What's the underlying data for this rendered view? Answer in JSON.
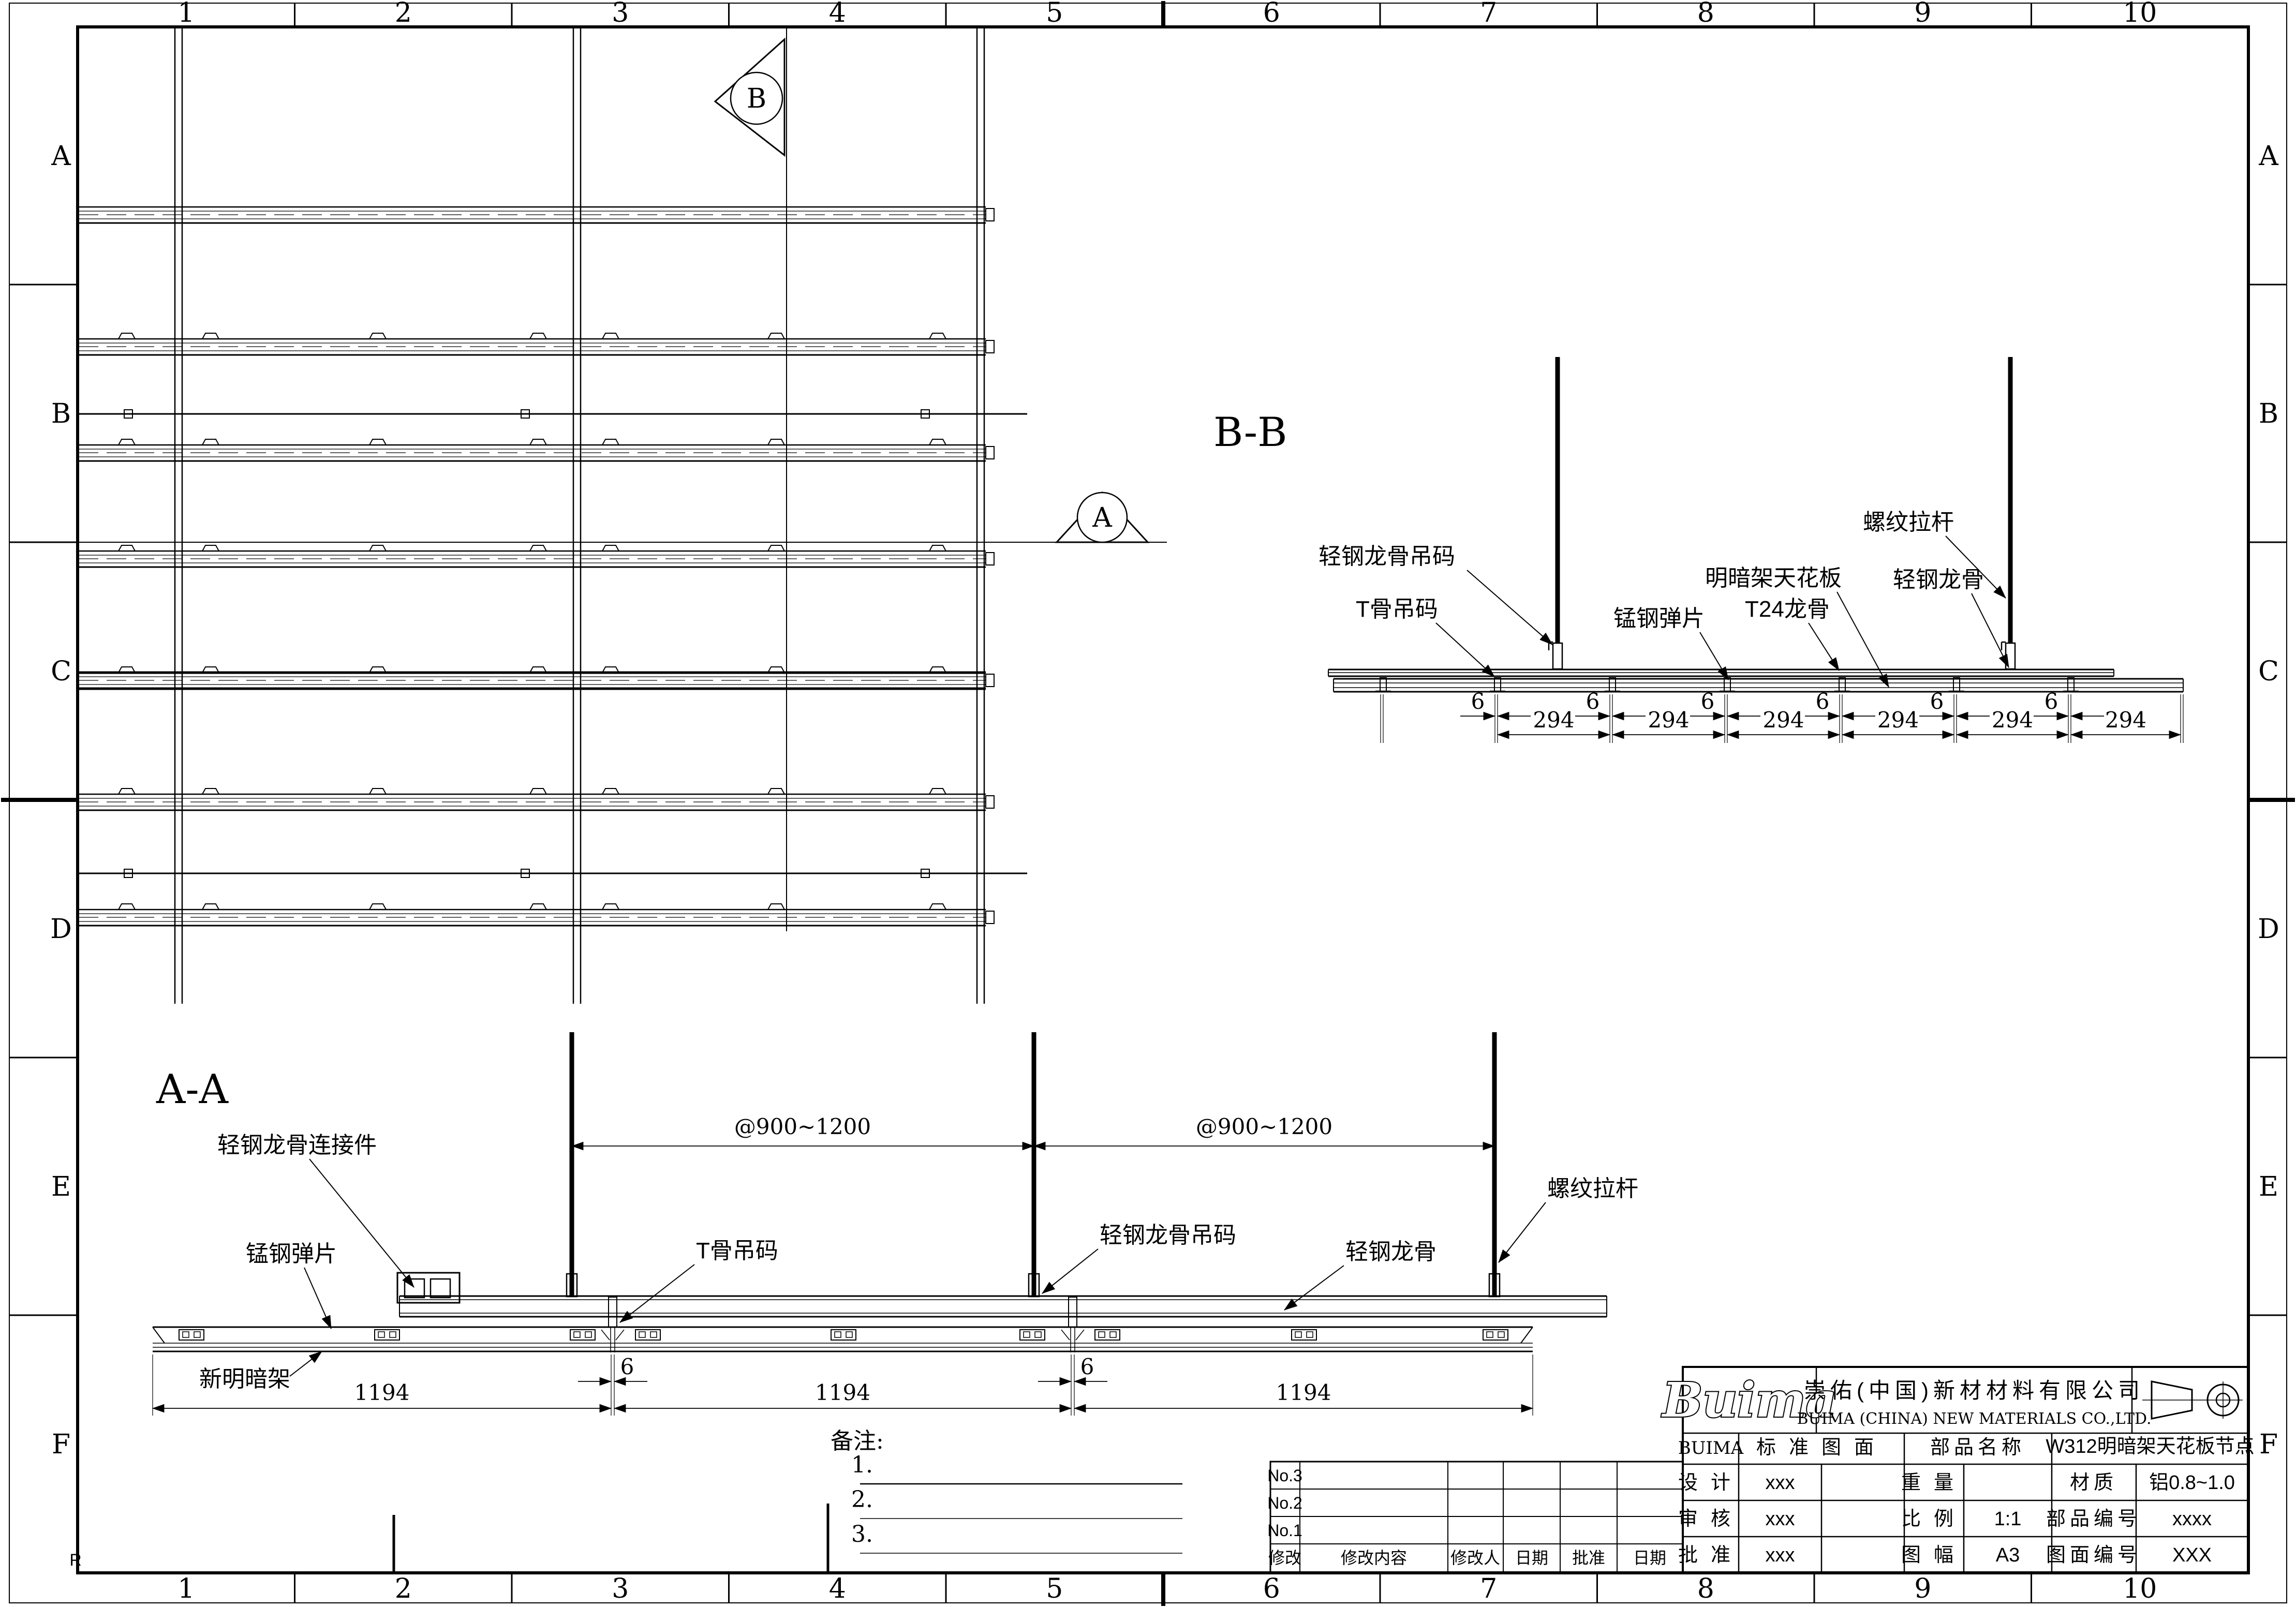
{
  "sheet": {
    "zones_top": [
      "1",
      "2",
      "3",
      "4",
      "5",
      "6",
      "7",
      "8",
      "9",
      "10"
    ],
    "zones_bottom": [
      "1",
      "2",
      "3",
      "4",
      "5",
      "6",
      "7",
      "8",
      "9",
      "10"
    ],
    "zones_left": [
      "A",
      "B",
      "C",
      "D",
      "E",
      "F"
    ],
    "zones_right": [
      "A",
      "B",
      "C",
      "D",
      "E",
      "F"
    ],
    "corner_mark": "R"
  },
  "plan": {
    "marker_b": "B",
    "marker_a": "A"
  },
  "bb": {
    "title": "B-B",
    "labels": {
      "rod": "螺纹拉杆",
      "keel_hanger": "轻钢龙骨吊码",
      "tbar_hanger": "T骨吊码",
      "spring": "锰钢弹片",
      "panel": "明暗架天花板",
      "t24": "T24龙骨",
      "keel": "轻钢龙骨"
    },
    "dims": {
      "gap": "6",
      "module": "294"
    }
  },
  "aa": {
    "title": "A-A",
    "labels": {
      "connector": "轻钢龙骨连接件",
      "spring": "锰钢弹片",
      "tbar_hanger": "T骨吊码",
      "keel_hanger": "轻钢龙骨吊码",
      "keel": "轻钢龙骨",
      "rod": "螺纹拉杆",
      "frame": "新明暗架"
    },
    "dims": {
      "spacing": "@900~1200",
      "panel": "1194",
      "gap": "6"
    }
  },
  "notes": {
    "title": "备注:",
    "items": [
      "1.",
      "2.",
      "3."
    ]
  },
  "rev": {
    "rows": [
      "No.3",
      "No.2",
      "No.1"
    ],
    "headers": [
      "修改",
      "修改内容",
      "修改人",
      "日期",
      "批准",
      "日期"
    ]
  },
  "tb": {
    "logo": "Buima",
    "company_cn": "崇佑(中国)新材材料有限公司",
    "company_en": "BUIMA (CHINA) NEW MATERIALS CO.,LTD.",
    "brand": "BUIMA",
    "std": "标准图面",
    "part_label": "部品名称",
    "part_name": "W312明暗架天花板节点",
    "r1": {
      "l": "设计",
      "v": "xxx",
      "p": "重量",
      "pv": "",
      "a": "材质",
      "av": "铝0.8~1.0"
    },
    "r2": {
      "l": "审核",
      "v": "xxx",
      "p": "比例",
      "pv": "1:1",
      "a": "部品编号",
      "av": "xxxx"
    },
    "r3": {
      "l": "批准",
      "v": "xxx",
      "p": "图幅",
      "pv": "A3",
      "a": "图面编号",
      "av": "XXX"
    }
  }
}
